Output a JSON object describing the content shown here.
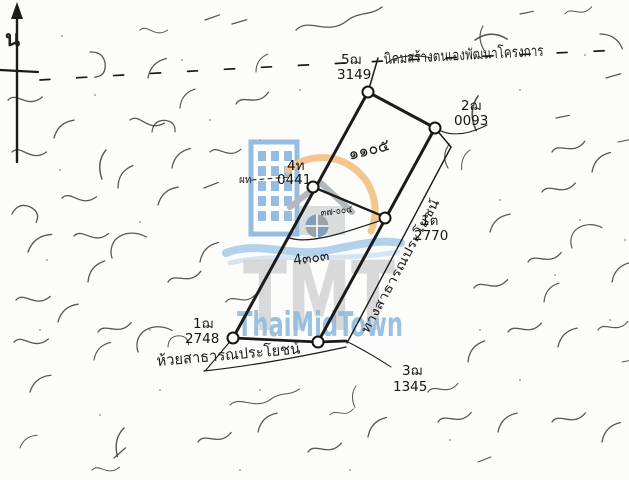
{
  "document": {
    "kind": "cadastral-survey-sketch"
  },
  "north_arrow": {
    "label": "น"
  },
  "settlement_boundary": {
    "label": "นิคมสร้างตนเองพัฒนาโครงการ"
  },
  "boundary_markers": {
    "top": {
      "id": "5ฌ",
      "no": "3149"
    },
    "northeast": {
      "id": "2ฌ",
      "no": "0093"
    },
    "middle_left": {
      "id": "4ท",
      "no": "0441"
    },
    "middle_left_small": {
      "id": "ผท"
    },
    "road_side": {
      "id": "1ต",
      "no": "2770"
    },
    "southwest": {
      "id": "1ฌ",
      "no": "2748"
    },
    "south": {
      "id": "3ฌ",
      "no": "1345"
    }
  },
  "parcels": {
    "upper_number": "๑๑๐๕",
    "middle_number": "๓๗-๐๐๔",
    "lower_number": "4๓๐๓"
  },
  "adjoiners": {
    "east_road_label": "ทางสาธารณประโยชน์",
    "south_creek_label": "ห้วยสาธารณประโยชน์"
  },
  "watermark": {
    "initials": "TMT",
    "brand": "ThaiMidTown",
    "colors": {
      "building_blue": "#85b3dd",
      "arc_orange": "#f2bd7c",
      "wave_blue": "#a4cbe8",
      "initials_gray": "#c9c9c9",
      "brand_blue": "#7fb0d8",
      "ink": "#1b1b1b"
    }
  }
}
